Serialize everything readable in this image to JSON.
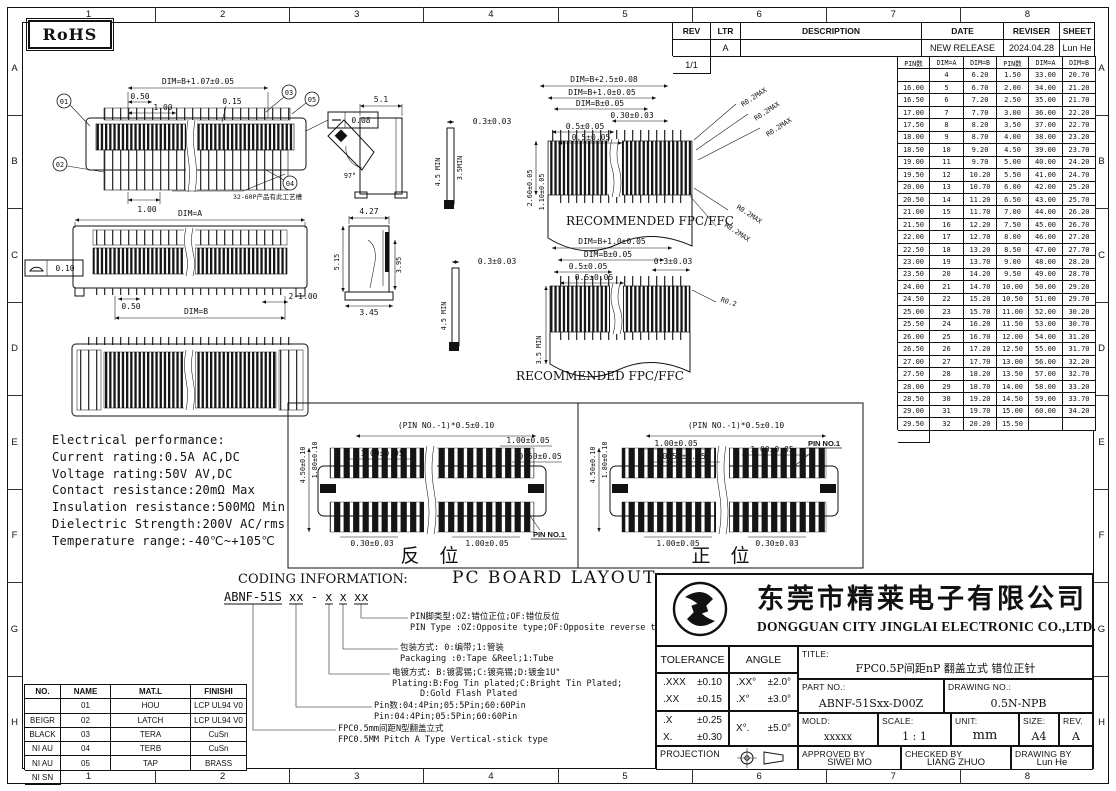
{
  "sheet": {
    "rohs": "RoHS",
    "grid_cols": [
      "1",
      "2",
      "3",
      "4",
      "5",
      "6",
      "7",
      "8"
    ],
    "grid_rows": [
      "A",
      "B",
      "C",
      "D",
      "E",
      "F",
      "G",
      "H"
    ]
  },
  "revision_table": {
    "headers": [
      "REV",
      "LTR",
      "DESCRIPTION",
      "DATE",
      "REVISER",
      "SHEET"
    ],
    "rows": [
      [
        "A",
        "",
        "NEW RELEASE",
        "2024.04.28",
        "Lun He",
        "1/1"
      ]
    ]
  },
  "pin_table": {
    "headers": [
      "PIN数",
      "DIM=A",
      "DIM=B",
      "PIN数",
      "DIM=A",
      "DIM=B"
    ],
    "rows": [
      [
        "4",
        "6.20",
        "1.50",
        "33.00",
        "20.70",
        "16.00"
      ],
      [
        "5",
        "6.70",
        "2.00",
        "34.00",
        "21.20",
        "16.50"
      ],
      [
        "6",
        "7.20",
        "2.50",
        "35.00",
        "21.70",
        "17.00"
      ],
      [
        "7",
        "7.70",
        "3.00",
        "36.00",
        "22.20",
        "17.50"
      ],
      [
        "8",
        "8.20",
        "3.50",
        "37.00",
        "22.70",
        "18.00"
      ],
      [
        "9",
        "8.70",
        "4.00",
        "38.00",
        "23.20",
        "18.50"
      ],
      [
        "10",
        "9.20",
        "4.50",
        "39.00",
        "23.70",
        "19.00"
      ],
      [
        "11",
        "9.70",
        "5.00",
        "40.00",
        "24.20",
        "19.50"
      ],
      [
        "12",
        "10.20",
        "5.50",
        "41.00",
        "24.70",
        "20.00"
      ],
      [
        "13",
        "10.70",
        "6.00",
        "42.00",
        "25.20",
        "20.50"
      ],
      [
        "14",
        "11.20",
        "6.50",
        "43.00",
        "25.70",
        "21.00"
      ],
      [
        "15",
        "11.70",
        "7.00",
        "44.00",
        "26.20",
        "21.50"
      ],
      [
        "16",
        "12.20",
        "7.50",
        "45.00",
        "26.70",
        "22.00"
      ],
      [
        "17",
        "12.70",
        "8.00",
        "46.00",
        "27.20",
        "22.50"
      ],
      [
        "18",
        "13.20",
        "8.50",
        "47.00",
        "27.70",
        "23.00"
      ],
      [
        "19",
        "13.70",
        "9.00",
        "48.00",
        "28.20",
        "23.50"
      ],
      [
        "20",
        "14.20",
        "9.50",
        "49.00",
        "28.70",
        "24.00"
      ],
      [
        "21",
        "14.70",
        "10.00",
        "50.00",
        "29.20",
        "24.50"
      ],
      [
        "22",
        "15.20",
        "10.50",
        "51.00",
        "29.70",
        "25.00"
      ],
      [
        "23",
        "15.70",
        "11.00",
        "52.00",
        "30.20",
        "25.50"
      ],
      [
        "24",
        "16.20",
        "11.50",
        "53.00",
        "30.70",
        "26.00"
      ],
      [
        "25",
        "16.70",
        "12.00",
        "54.00",
        "31.20",
        "26.50"
      ],
      [
        "26",
        "17.20",
        "12.50",
        "55.00",
        "31.70",
        "27.00"
      ],
      [
        "27",
        "17.70",
        "13.00",
        "56.00",
        "32.20",
        "27.50"
      ],
      [
        "28",
        "18.20",
        "13.50",
        "57.00",
        "32.70",
        "28.00"
      ],
      [
        "29",
        "18.70",
        "14.00",
        "58.00",
        "33.20",
        "28.50"
      ],
      [
        "30",
        "19.20",
        "14.50",
        "59.00",
        "33.70",
        "29.00"
      ],
      [
        "31",
        "19.70",
        "15.00",
        "60.00",
        "34.20",
        "29.50"
      ],
      [
        "32",
        "20.20",
        "15.50",
        "",
        "",
        ""
      ]
    ]
  },
  "electrical": {
    "title": "Electrical performance:",
    "lines": [
      "Current rating:0.5A AC,DC",
      "Voltage rating:50V AV,DC",
      "Contact resistance:20mΩ Max",
      "Insulation resistance:500MΩ Min",
      "Dielectric Strength:200V AC/rms",
      "Temperature range:-40℃~+105℃"
    ]
  },
  "coding": {
    "title": "CODING INFORMATION:",
    "code": "ABNF-51S xx - x x xx",
    "items": [
      {
        "zh": "PIN脚类型:OZ:错位正位;OF:错位反位",
        "en": "PIN Type :OZ:Opposite type;OF:Opposite reverse type",
        "en2": ""
      },
      {
        "zh": "包装方式: 0:编带;1:管装",
        "en": "Packaging :0:Tape &Reel;1:Tube",
        "en2": ""
      },
      {
        "zh": "电镀方式: B:镀雾锡;C:镀亮锡;D:镀金1U\"",
        "en": "Plating:B:Fog Tin plated;C:Bright Tin Plated;",
        "en2": "D:Gold Flash Plated"
      },
      {
        "zh": "Pin数:04:4Pin;05:5Pin;60:60Pin",
        "en": "Pin:04:4Pin;05:5Pin;60:60Pin",
        "en2": ""
      },
      {
        "zh": "FPC0.5mm间距N型翻盖立式",
        "en": "FPC0.5MM Pitch A Type Vertical-stick type",
        "en2": ""
      }
    ]
  },
  "pcb": {
    "title": "PC BOARD LAYOUT",
    "left_caption": "反 位",
    "right_caption": "正 位"
  },
  "parts_table": {
    "headers": [
      "NO.",
      "NAME",
      "MAT.L",
      "FINISHI"
    ],
    "rows": [
      [
        "01",
        "HOU",
        "LCP UL94 V0",
        "BEIGR"
      ],
      [
        "02",
        "LATCH",
        "LCP UL94 V0",
        "BLACK"
      ],
      [
        "03",
        "TERA",
        "CuSn",
        "NI AU"
      ],
      [
        "04",
        "TERB",
        "CuSn",
        "NI AU"
      ],
      [
        "05",
        "TAP",
        "BRASS",
        "NI SN"
      ]
    ]
  },
  "title_block": {
    "company_zh": "东莞市精莱电子有限公司",
    "company_en": "DONGGUAN CITY JINGLAI ELECTRONIC CO.,LTD.",
    "tolerance_label": "TOLERANCE",
    "angle_label": "ANGLE",
    "tolerances": [
      [
        ".XXX",
        "±0.10"
      ],
      [
        ".XX",
        "±0.15"
      ],
      [
        ".X",
        "±0.25"
      ],
      [
        "X.",
        "±0.30"
      ]
    ],
    "angles": [
      [
        ".XX°",
        "±2.0°"
      ],
      [
        ".X°",
        "±3.0°"
      ],
      [
        "X°.",
        "±5.0°"
      ]
    ],
    "title_label": "TITLE:",
    "title_value": "FPC0.5P间距nP 翻盖立式 错位正针",
    "part_no_label": "PART NO.:",
    "part_no": "ABNF-51Sxx-D00Z",
    "drawing_no_label": "DRAWING NO.:",
    "drawing_no": "0.5N-NPB",
    "mold_label": "MOLD:",
    "mold": "xxxxx",
    "scale_label": "SCALE:",
    "scale": "1 : 1",
    "unit_label": "UNIT:",
    "unit": "mm",
    "size_label": "SIZE:",
    "size": "A4",
    "rev_label": "REV.",
    "rev": "A",
    "projection_label": "PROJECTION",
    "approved_label": "APPROVED BY",
    "approved": "SIWEI MO",
    "checked_label": "CHECKED BY",
    "checked": "LIANG ZHUO",
    "drawn_label": "DRAWING BY",
    "drawn": "Lun He"
  },
  "dims": {
    "fv1_total": "DIM=B+1.07±0.05",
    "fv1_050": "0.50",
    "fv1_100": "1.00",
    "fv1_015": "0.15",
    "fv1_flat": "0.08",
    "fv1_100b": "1.00",
    "fv1_note": "32-60P产品有此工艺槽",
    "b01": "01",
    "b02": "02",
    "b03": "03",
    "b04": "04",
    "b05": "05",
    "sv1_w": "5.1",
    "sv1_ang": "97°",
    "fv2_dima": "DIM=A",
    "fv2_050": "0.50",
    "fv2_dimb": "DIM=B",
    "fv2_2100": "2-1.00",
    "fv2_flat": "0.10",
    "sv2_427": "4.27",
    "sv2_515": "5.15",
    "sv2_395": "3.95",
    "sv2_345": "3.45",
    "fpc1_d1": "DIM=B+2.5±0.08",
    "fpc1_d2": "DIM=B+1.0±0.05",
    "fpc1_d3": "DIM=B±0.05",
    "fpc1_d4": "0.30±0.03",
    "fpc1_d5": "0.5±0.05",
    "fpc1_d6": "0.5±0.05",
    "fpc1_d7": "0.3±0.03",
    "fpc1_45": "4.5 MIN",
    "fpc1_35": "3.5MIN",
    "fpc1_260": "2.60±0.05",
    "fpc1_110": "1.10±0.05",
    "fpc1_r": "R0.2MAX",
    "fpc1_cap": "RECOMMENDED FPC/FFC",
    "fpc2_d1": "DIM=B+1.0±0.05",
    "fpc2_d2": "DIM=B±0.05",
    "fpc2_d3": "0.5±0.05",
    "fpc2_d4": "0.5±0.05",
    "fpc2_d5": "0.3±0.03",
    "fpc2_d6": "0.3±0.03",
    "fpc2_45": "4.5 MIN",
    "fpc2_35": "3.5 MIN",
    "fpc2_r": "R0.2",
    "fpc2_cap": "RECOMMENDED FPC/FFC",
    "pcb_450": "4.50±0.10",
    "pcb_180": "1.80±0.10",
    "pcb_pitch": "(PIN NO.-1)*0.5±0.10",
    "pcb_100": "1.00±0.05",
    "pcb_050": "0.50±0.05",
    "pcb_030": "0.30±0.03",
    "pcb_pin1": "PIN NO.1"
  }
}
